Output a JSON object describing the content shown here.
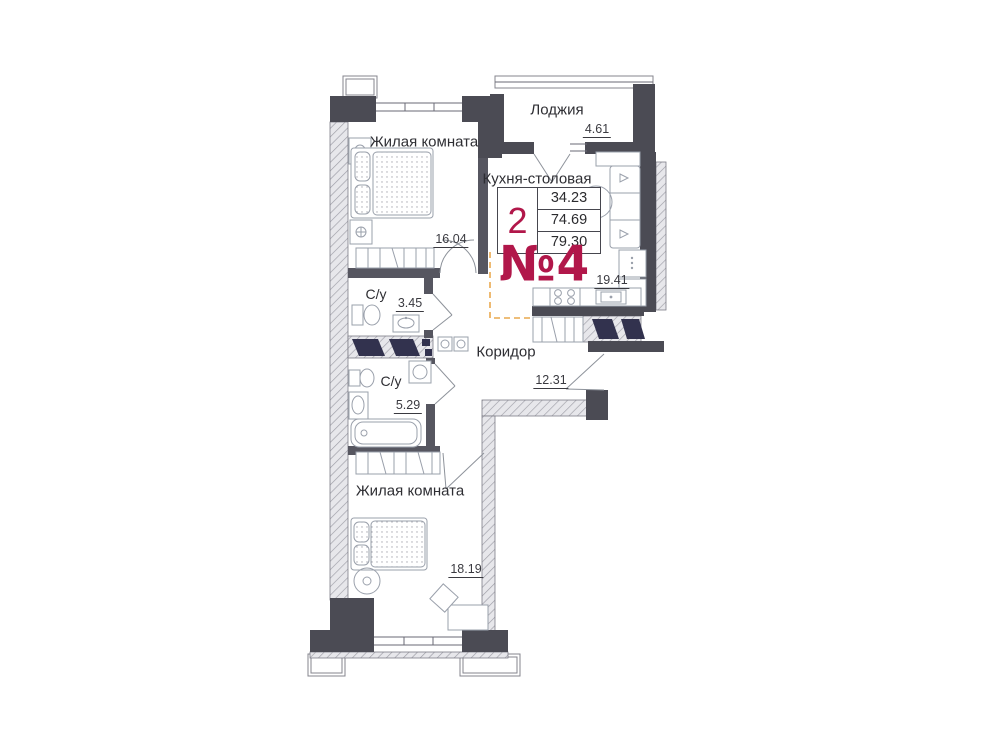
{
  "apartment": {
    "number_label": "№4",
    "stamp": {
      "rooms_count": "2",
      "values": [
        "34.23",
        "74.69",
        "79.30"
      ]
    },
    "rooms": [
      {
        "id": "loggia",
        "label": "Лоджия",
        "area": "4.61"
      },
      {
        "id": "living-room-1",
        "label": "Жилая комната",
        "area": "16.04"
      },
      {
        "id": "kitchen-dining",
        "label": "Кухня-столовая",
        "area": "19.41"
      },
      {
        "id": "bathroom-1",
        "label": "С/у",
        "area": "3.45"
      },
      {
        "id": "corridor",
        "label": "Коридор",
        "area": "12.31"
      },
      {
        "id": "bathroom-2",
        "label": "С/у",
        "area": "5.29"
      },
      {
        "id": "living-room-2",
        "label": "Жилая комната",
        "area": "18.19"
      }
    ],
    "colors": {
      "wall": "#4b4b54",
      "wall_interior": "#565660",
      "accent_red": "#b1174a",
      "zone_dash": "#e9a94f",
      "navy": "#32324e",
      "furniture_line": "#9aa0ab"
    }
  }
}
